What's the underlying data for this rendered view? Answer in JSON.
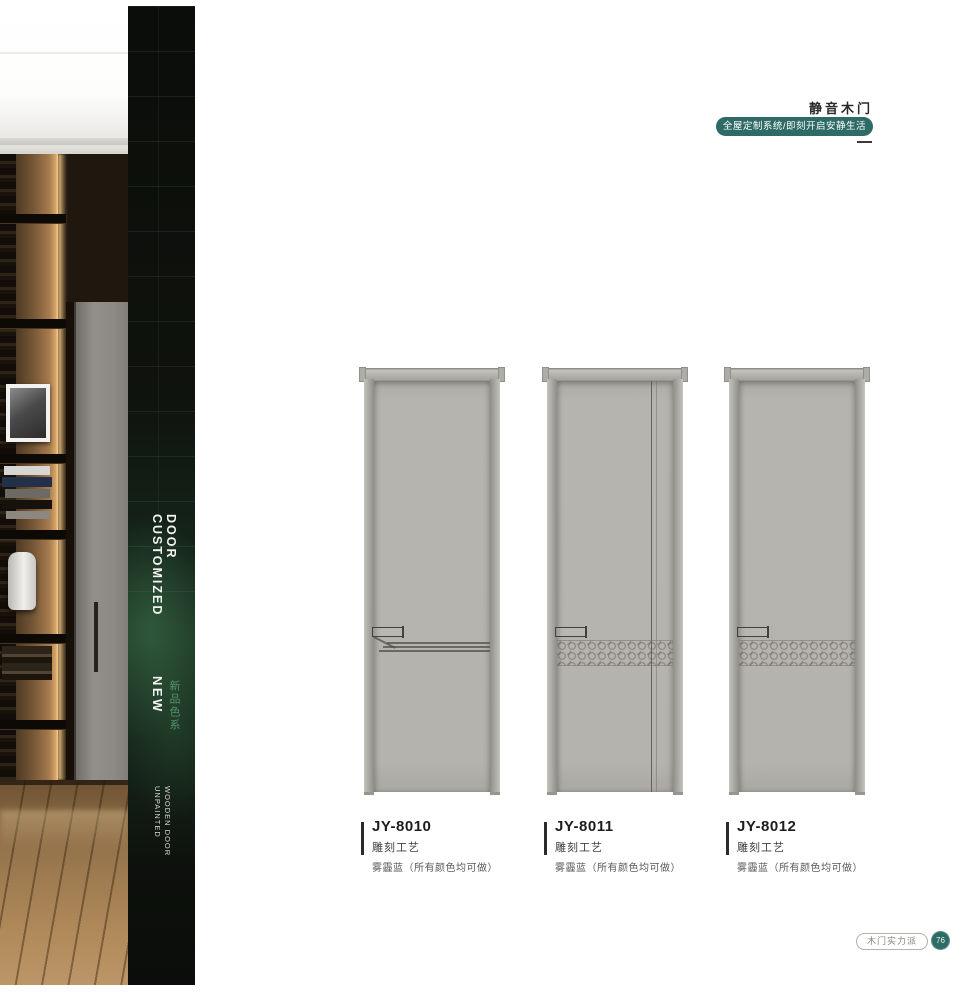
{
  "header": {
    "title": "静音木门",
    "tagline": "全屋定制系统/即刻开启安静生活"
  },
  "sidebar": {
    "customized": "CUSTOMIZED",
    "door": "DOOR",
    "new_label": "NEW",
    "new_series": "新品色系",
    "unpainted": "UNPAINTED",
    "wooden_door": "WOODEN DOOR"
  },
  "products": [
    {
      "model": "JY-8010",
      "craft": "雕刻工艺",
      "finish": "雾霾蓝（所有颜色均可做）"
    },
    {
      "model": "JY-8011",
      "craft": "雕刻工艺",
      "finish": "雾霾蓝（所有颜色均可做）"
    },
    {
      "model": "JY-8012",
      "craft": "雕刻工艺",
      "finish": "雾霾蓝（所有颜色均可做）"
    }
  ],
  "footer": {
    "badge": "木门实力派",
    "page_number": "76"
  },
  "colors": {
    "accent_teal": "#2e6b66",
    "door_gray": "#b5b3ad",
    "band_dark": "#0e120d",
    "series_green": "#55906b"
  }
}
